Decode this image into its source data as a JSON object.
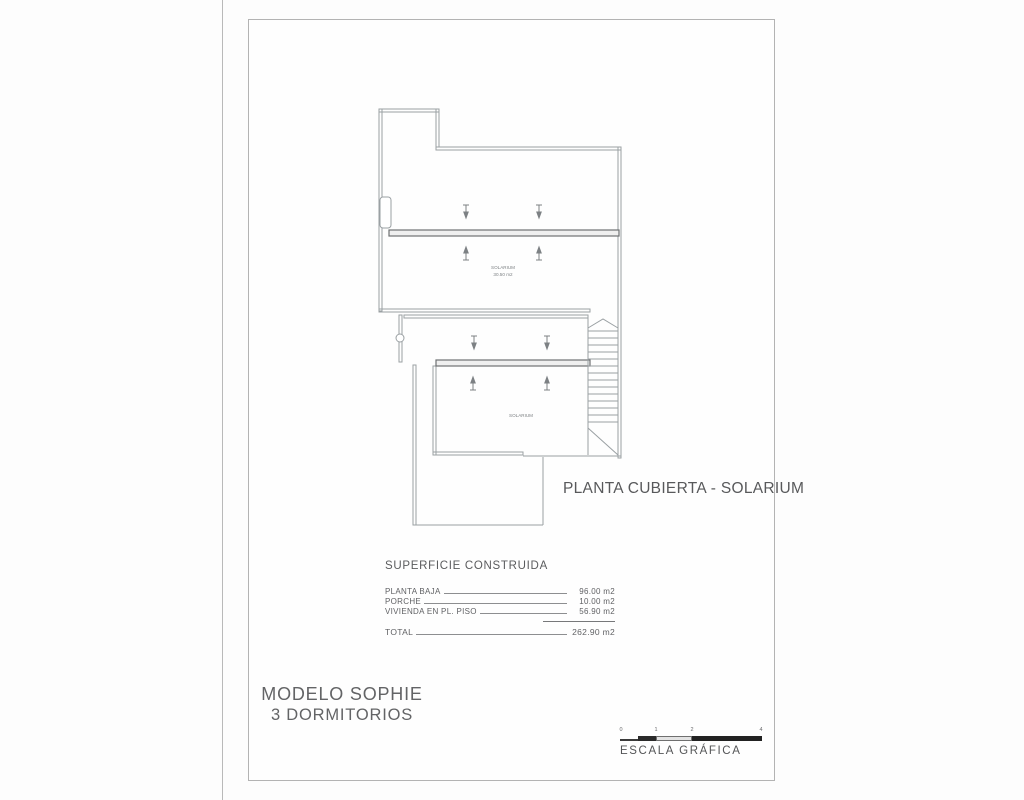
{
  "plan": {
    "caption": "PLANTA CUBIERTA - SOLARIUM",
    "upper_room_label_line1": "SOLARIUM",
    "upper_room_label_line2": "30.50 m2",
    "lower_room_label": "SOLARIUM"
  },
  "summary": {
    "title": "SUPERFICIE CONSTRUIDA",
    "rows": [
      {
        "label": "PLANTA BAJA",
        "value": "96.00 m2"
      },
      {
        "label": "PORCHE",
        "value": "10.00 m2"
      },
      {
        "label": "VIVIENDA EN PL. PISO",
        "value": "56.90 m2"
      }
    ],
    "total": {
      "label": "TOTAL",
      "value": "262.90 m2"
    }
  },
  "footer": {
    "model": "MODELO SOPHIE",
    "subtitle": "3 DORMITORIOS"
  },
  "scale": {
    "label": "ESCALA GRÁFICA",
    "ticks": [
      "0",
      "1",
      "2",
      "4"
    ]
  },
  "colors": {
    "thin_line": "#9aa0a3",
    "thick_line": "#6e7173",
    "text_gray": "#5f6368"
  }
}
